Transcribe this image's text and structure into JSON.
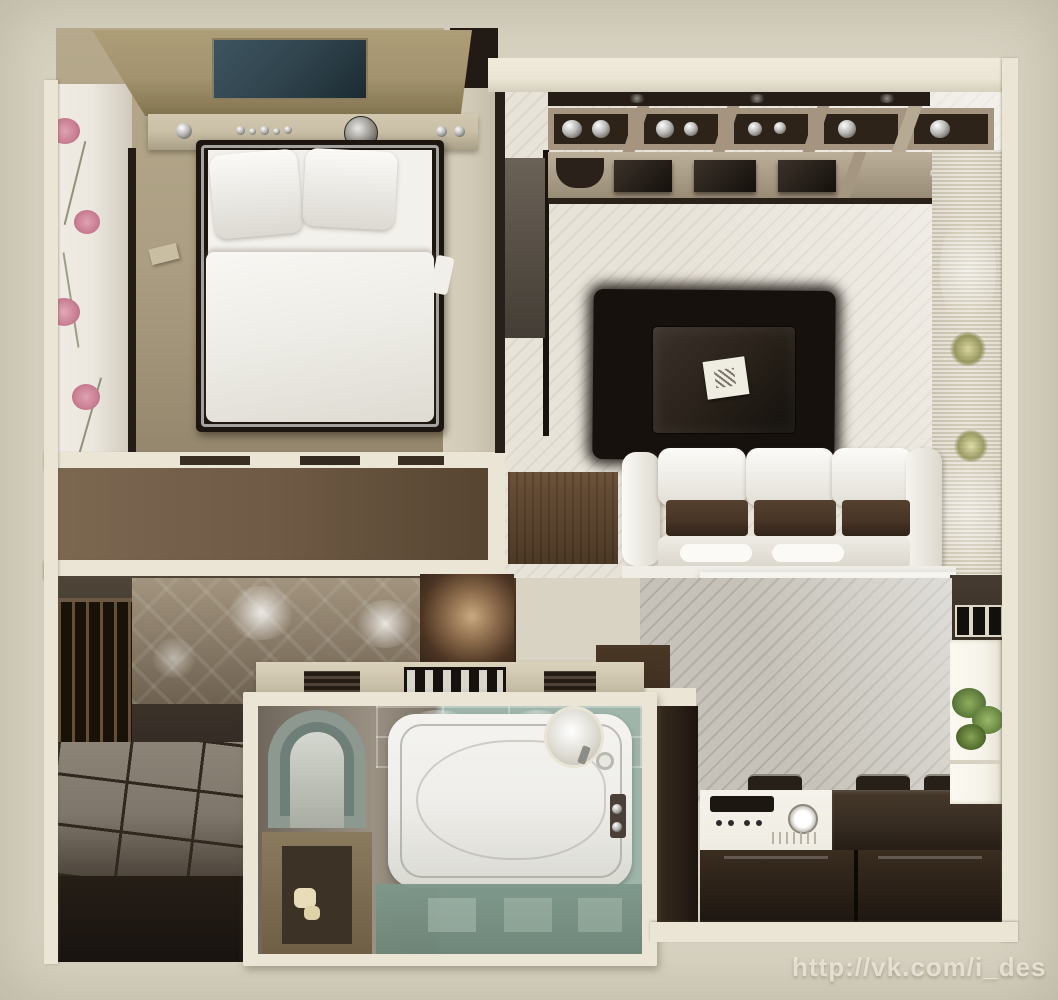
{
  "scene": {
    "type": "apartment-floor-plan-3d-top-view",
    "rooms": [
      "bedroom",
      "living-room",
      "kitchen",
      "bathroom",
      "hallway",
      "corridor"
    ]
  },
  "watermark": {
    "text": "http://vk.com/i_des"
  },
  "palette": {
    "background": "#d8d3c2",
    "wall": "#eae5d4",
    "carpet": "#ab9e82",
    "floral_wall": "#ece7df",
    "flower_pink": "#c97e93",
    "canopy": "#a3946f",
    "teal_panel": "#30444e",
    "shelf": "#c9bfa7",
    "bed_frame": "#1c1510",
    "bed_trim": "#bcbcb8",
    "linen": "#f3f1ec",
    "accent_pillow": "#7c695b",
    "duvet": "#eeede7",
    "corridor_floor": "#6e5a45",
    "living_floor": "#e8e3d9",
    "plank_line": "#b5ac9c",
    "media_beige": "#a59480",
    "media_dark": "#261e16",
    "rug_black": "#16110d",
    "table_dark": "#2c241c",
    "sofa_white": "#f0ede6",
    "cushion_brown": "#463426",
    "bar_white": "#f2f0e9",
    "stool_white": "#f4f2ec",
    "kitchen_dark": "#2e2318",
    "counter_dark": "#392e23",
    "stove_white": "#efece3",
    "window_light": "#f6f4ea",
    "plant_green": "#5f7c3e",
    "glass_teal": "#9fb5aa",
    "glass_deep": "#7e988b",
    "tub_white": "#efeeea",
    "niche_tan": "#8a7a5e",
    "hall_base": "#4e4438",
    "hall_dark": "#241d16",
    "pattern_wall": "#a2947e",
    "tile_gray": "#7e766a",
    "tile_line": "#2f281f",
    "wardrobe_dark": "#181209",
    "slat_brown": "#63503c",
    "stripe_dark": "#27201a",
    "curtain_beige": "#ddd6c4"
  }
}
